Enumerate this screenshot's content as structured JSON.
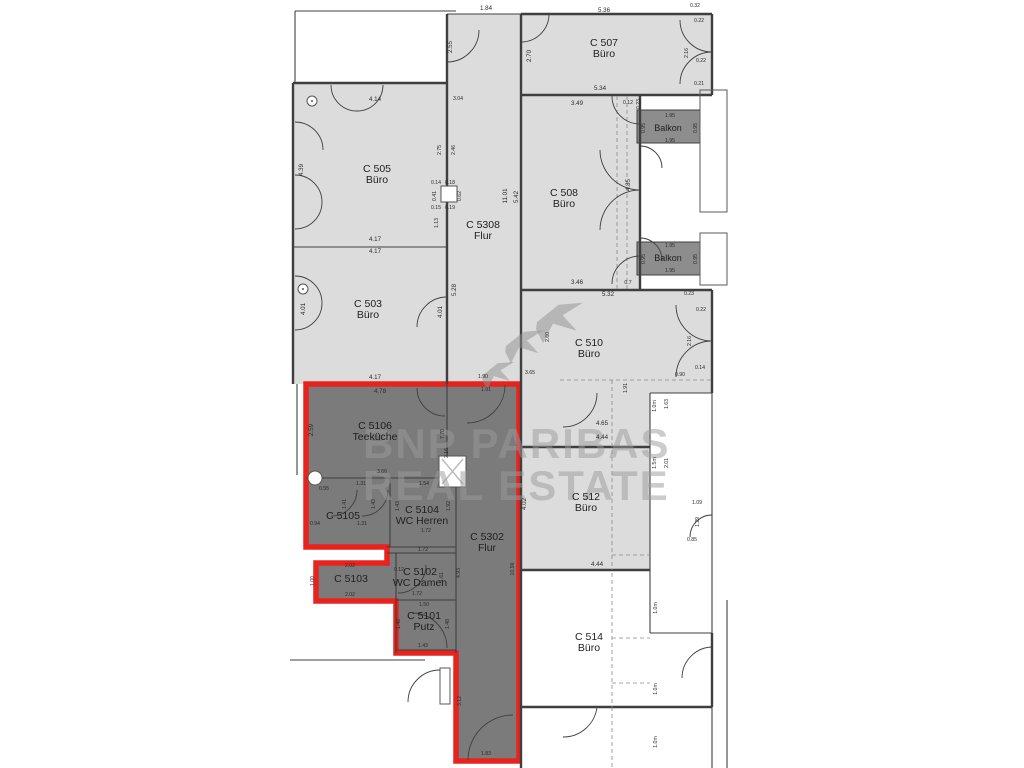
{
  "watermark": {
    "line1": "BNP PARIBAS",
    "line2": "REAL ESTATE"
  },
  "colors": {
    "room_light": "#dcdcdc",
    "room_dark": "#7b7b7b",
    "balcony": "#8d8d8d",
    "highlight_red": "#e8231d",
    "wall": "#3f3f3f",
    "dim_text": "#2b2b2b",
    "watermark_gray": "#9b9b9b"
  },
  "rooms": [
    {
      "id": "c505",
      "code": "C 505",
      "type": "Büro",
      "x": 377,
      "y": 172,
      "highlighted": false
    },
    {
      "id": "c503",
      "code": "C 503",
      "type": "Büro",
      "x": 368,
      "y": 307,
      "highlighted": false
    },
    {
      "id": "c5308",
      "code": "C 5308",
      "type": "Flur",
      "x": 483,
      "y": 228,
      "highlighted": false
    },
    {
      "id": "c507",
      "code": "C 507",
      "type": "Büro",
      "x": 604,
      "y": 46,
      "highlighted": false
    },
    {
      "id": "c508",
      "code": "C 508",
      "type": "Büro",
      "x": 564,
      "y": 196,
      "highlighted": false
    },
    {
      "id": "balkon-1",
      "code": "Balkon",
      "type": "",
      "x": 668,
      "y": 131,
      "small": true,
      "highlighted": false
    },
    {
      "id": "balkon-2",
      "code": "Balkon",
      "type": "",
      "x": 668,
      "y": 261,
      "small": true,
      "highlighted": false
    },
    {
      "id": "c510",
      "code": "C 510",
      "type": "Büro",
      "x": 589,
      "y": 346,
      "highlighted": false
    },
    {
      "id": "c512",
      "code": "C 512",
      "type": "Büro",
      "x": 586,
      "y": 500,
      "highlighted": false
    },
    {
      "id": "c514",
      "code": "C 514",
      "type": "Büro",
      "x": 589,
      "y": 640,
      "highlighted": false
    },
    {
      "id": "c5106",
      "code": "C 5106",
      "type": "Teeküche",
      "x": 375,
      "y": 429,
      "highlighted": true
    },
    {
      "id": "c5105",
      "code": "C 5105",
      "type": "",
      "x": 343,
      "y": 519,
      "highlighted": true
    },
    {
      "id": "c5104",
      "code": "C 5104",
      "type": "WC Herren",
      "x": 422,
      "y": 513,
      "highlighted": true
    },
    {
      "id": "c5302",
      "code": "C 5302",
      "type": "Flur",
      "x": 487,
      "y": 540,
      "highlighted": true
    },
    {
      "id": "c5103",
      "code": "C 5103",
      "type": "",
      "x": 351,
      "y": 582,
      "highlighted": true
    },
    {
      "id": "c5102",
      "code": "C 5102",
      "type": "WC Damen",
      "x": 420,
      "y": 575,
      "highlighted": true
    },
    {
      "id": "c5101",
      "code": "C 5101",
      "type": "Putz",
      "x": 424,
      "y": 619,
      "highlighted": true
    }
  ],
  "dimensions": [
    {
      "t": "1.84",
      "x": 486,
      "y": 10,
      "r": 0
    },
    {
      "t": "2.55",
      "x": 452,
      "y": 47,
      "r": 90
    },
    {
      "t": "3.04",
      "x": 458,
      "y": 100,
      "r": 0,
      "s": 5
    },
    {
      "t": "4.14",
      "x": 375,
      "y": 101,
      "r": 0
    },
    {
      "t": "4.39",
      "x": 303,
      "y": 170,
      "r": 90
    },
    {
      "t": "2.75",
      "x": 441,
      "y": 150,
      "r": 90,
      "s": 5
    },
    {
      "t": "2.46",
      "x": 455,
      "y": 150,
      "r": 90,
      "s": 5
    },
    {
      "t": "0.14",
      "x": 436,
      "y": 184,
      "r": 0,
      "s": 5
    },
    {
      "t": "0.18",
      "x": 450,
      "y": 184,
      "r": 0,
      "s": 5
    },
    {
      "t": "0.41",
      "x": 436,
      "y": 196,
      "r": 90,
      "s": 5
    },
    {
      "t": "0.62",
      "x": 461,
      "y": 196,
      "r": 90,
      "s": 5
    },
    {
      "t": "0.15",
      "x": 436,
      "y": 209,
      "r": 0,
      "s": 5
    },
    {
      "t": "0.19",
      "x": 450,
      "y": 209,
      "r": 0,
      "s": 5
    },
    {
      "t": "1.13",
      "x": 438,
      "y": 223,
      "r": 90,
      "s": 5
    },
    {
      "t": "4.17",
      "x": 375,
      "y": 241,
      "r": 0
    },
    {
      "t": "4.17",
      "x": 375,
      "y": 253,
      "r": 0
    },
    {
      "t": "4.01",
      "x": 305,
      "y": 309,
      "r": 90
    },
    {
      "t": "4.01",
      "x": 442,
      "y": 312,
      "r": 90
    },
    {
      "t": "5.28",
      "x": 456,
      "y": 290,
      "r": 90
    },
    {
      "t": "11.01",
      "x": 507,
      "y": 196,
      "r": 90
    },
    {
      "t": "5.42",
      "x": 518,
      "y": 197,
      "r": 90
    },
    {
      "t": "4.17",
      "x": 375,
      "y": 379,
      "r": 0
    },
    {
      "t": "5.36",
      "x": 604,
      "y": 12,
      "r": 0
    },
    {
      "t": "2.70",
      "x": 531,
      "y": 56,
      "r": 90
    },
    {
      "t": "5.34",
      "x": 600,
      "y": 90,
      "r": 0
    },
    {
      "t": "0.32",
      "x": 695,
      "y": 7,
      "r": 0,
      "s": 5
    },
    {
      "t": "0.22",
      "x": 699,
      "y": 22,
      "r": 0,
      "s": 5
    },
    {
      "t": "0.22",
      "x": 701,
      "y": 62,
      "r": 0,
      "s": 5
    },
    {
      "t": "0.21",
      "x": 699,
      "y": 85,
      "r": 0,
      "s": 5
    },
    {
      "t": "2.16",
      "x": 688,
      "y": 53,
      "r": 90,
      "s": 5
    },
    {
      "t": "3.49",
      "x": 577,
      "y": 105,
      "r": 0
    },
    {
      "t": "0.12",
      "x": 628,
      "y": 104,
      "r": 0,
      "s": 5
    },
    {
      "t": "0.23",
      "x": 640,
      "y": 104,
      "r": 90,
      "s": 5
    },
    {
      "t": "1.95",
      "x": 670,
      "y": 117,
      "r": 0,
      "s": 5
    },
    {
      "t": "0.95",
      "x": 645,
      "y": 128,
      "r": 90,
      "s": 5
    },
    {
      "t": "0.95",
      "x": 697,
      "y": 128,
      "r": 90,
      "s": 5
    },
    {
      "t": "1.95",
      "x": 670,
      "y": 142,
      "r": 0,
      "s": 5
    },
    {
      "t": "4.85",
      "x": 630,
      "y": 185,
      "r": 90
    },
    {
      "t": "1.95",
      "x": 670,
      "y": 247,
      "r": 0,
      "s": 5
    },
    {
      "t": "0.95",
      "x": 645,
      "y": 259,
      "r": 90,
      "s": 5
    },
    {
      "t": "0.95",
      "x": 697,
      "y": 259,
      "r": 90,
      "s": 5
    },
    {
      "t": "1.95",
      "x": 670,
      "y": 272,
      "r": 0,
      "s": 5
    },
    {
      "t": "3.46",
      "x": 577,
      "y": 284,
      "r": 0
    },
    {
      "t": "0.7",
      "x": 628,
      "y": 284,
      "r": 0,
      "s": 5
    },
    {
      "t": "5.32",
      "x": 608,
      "y": 296,
      "r": 0
    },
    {
      "t": "0.23",
      "x": 689,
      "y": 295,
      "r": 0,
      "s": 5
    },
    {
      "t": "0.22",
      "x": 701,
      "y": 311,
      "r": 0,
      "s": 5
    },
    {
      "t": "2.16",
      "x": 691,
      "y": 341,
      "r": 90,
      "s": 5
    },
    {
      "t": "0.14",
      "x": 700,
      "y": 369,
      "r": 0,
      "s": 5
    },
    {
      "t": "0.90",
      "x": 680,
      "y": 376,
      "r": 0,
      "s": 5
    },
    {
      "t": "4.65",
      "x": 602,
      "y": 425,
      "r": 0
    },
    {
      "t": "4.44",
      "x": 602,
      "y": 439,
      "r": 0
    },
    {
      "t": "1.91",
      "x": 627,
      "y": 388,
      "r": 90,
      "s": 5
    },
    {
      "t": "1.0m",
      "x": 656,
      "y": 406,
      "r": 90,
      "s": 5
    },
    {
      "t": "1.63",
      "x": 668,
      "y": 404,
      "r": 90,
      "s": 5
    },
    {
      "t": "1.5m",
      "x": 656,
      "y": 463,
      "r": 90,
      "s": 5
    },
    {
      "t": "2.01",
      "x": 668,
      "y": 463,
      "r": 90,
      "s": 5
    },
    {
      "t": "4.02",
      "x": 526,
      "y": 504,
      "r": 90
    },
    {
      "t": "1.09",
      "x": 697,
      "y": 504,
      "r": 0,
      "s": 5
    },
    {
      "t": "1.29",
      "x": 699,
      "y": 522,
      "r": 90,
      "s": 5
    },
    {
      "t": "0.85",
      "x": 692,
      "y": 541,
      "r": 0,
      "s": 5
    },
    {
      "t": "4.44",
      "x": 597,
      "y": 566,
      "r": 0
    },
    {
      "t": "1.0m",
      "x": 657,
      "y": 608,
      "r": 90,
      "s": 5
    },
    {
      "t": "1.0m",
      "x": 657,
      "y": 689,
      "r": 90,
      "s": 5
    },
    {
      "t": "1.0m",
      "x": 657,
      "y": 742,
      "r": 90,
      "s": 5
    },
    {
      "t": "4.78",
      "x": 380,
      "y": 393,
      "r": 0
    },
    {
      "t": "1.90",
      "x": 483,
      "y": 378,
      "r": 0,
      "s": 5
    },
    {
      "t": "1.91",
      "x": 486,
      "y": 391,
      "r": 0,
      "s": 5
    },
    {
      "t": "2.59",
      "x": 313,
      "y": 430,
      "r": 90
    },
    {
      "t": "7.70",
      "x": 444,
      "y": 434,
      "r": 90,
      "s": 5
    },
    {
      "t": "2.16",
      "x": 448,
      "y": 453,
      "r": 90,
      "s": 5
    },
    {
      "t": "2.60",
      "x": 549,
      "y": 337,
      "r": 90,
      "s": 5
    },
    {
      "t": "3.65",
      "x": 530,
      "y": 374,
      "r": 0,
      "s": 5
    },
    {
      "t": "3.66",
      "x": 382,
      "y": 473,
      "r": 0,
      "s": 5
    },
    {
      "t": "1.31",
      "x": 361,
      "y": 485,
      "r": 0,
      "s": 5
    },
    {
      "t": "0.55",
      "x": 324,
      "y": 490,
      "r": 0,
      "s": 5
    },
    {
      "t": "1.54",
      "x": 424,
      "y": 485,
      "r": 0,
      "s": 5
    },
    {
      "t": "1.41",
      "x": 346,
      "y": 504,
      "r": 90,
      "s": 5
    },
    {
      "t": "1.43",
      "x": 375,
      "y": 504,
      "r": 90,
      "s": 5
    },
    {
      "t": "1.43",
      "x": 399,
      "y": 506,
      "r": 90,
      "s": 5
    },
    {
      "t": "1.92",
      "x": 450,
      "y": 506,
      "r": 90,
      "s": 5
    },
    {
      "t": "0.94",
      "x": 315,
      "y": 525,
      "r": 0,
      "s": 5
    },
    {
      "t": "1.31",
      "x": 362,
      "y": 525,
      "r": 0,
      "s": 5
    },
    {
      "t": "1.72",
      "x": 426,
      "y": 532,
      "r": 0,
      "s": 5
    },
    {
      "t": "1.72",
      "x": 423,
      "y": 551,
      "r": 0,
      "s": 5
    },
    {
      "t": "2.02",
      "x": 350,
      "y": 567,
      "r": 0,
      "s": 5
    },
    {
      "t": "0.12",
      "x": 399,
      "y": 571,
      "r": 0,
      "s": 5
    },
    {
      "t": "1.00",
      "x": 314,
      "y": 581,
      "r": 90,
      "s": 5
    },
    {
      "t": "1.61",
      "x": 443,
      "y": 577,
      "r": 90,
      "s": 5
    },
    {
      "t": "4.93",
      "x": 460,
      "y": 573,
      "r": 90,
      "s": 5
    },
    {
      "t": "10.96",
      "x": 514,
      "y": 569,
      "r": 90,
      "s": 5
    },
    {
      "t": "2.02",
      "x": 350,
      "y": 596,
      "r": 0,
      "s": 5
    },
    {
      "t": "1.72",
      "x": 417,
      "y": 595,
      "r": 0,
      "s": 5
    },
    {
      "t": "1.50",
      "x": 424,
      "y": 606,
      "r": 0,
      "s": 5
    },
    {
      "t": "1.48",
      "x": 400,
      "y": 624,
      "r": 90,
      "s": 5
    },
    {
      "t": "1.48",
      "x": 449,
      "y": 624,
      "r": 90,
      "s": 5
    },
    {
      "t": "1.43",
      "x": 423,
      "y": 647,
      "r": 0,
      "s": 5
    },
    {
      "t": "3.12",
      "x": 461,
      "y": 701,
      "r": 90,
      "s": 5
    },
    {
      "t": "1.83",
      "x": 486,
      "y": 755,
      "r": 0,
      "s": 5
    }
  ]
}
